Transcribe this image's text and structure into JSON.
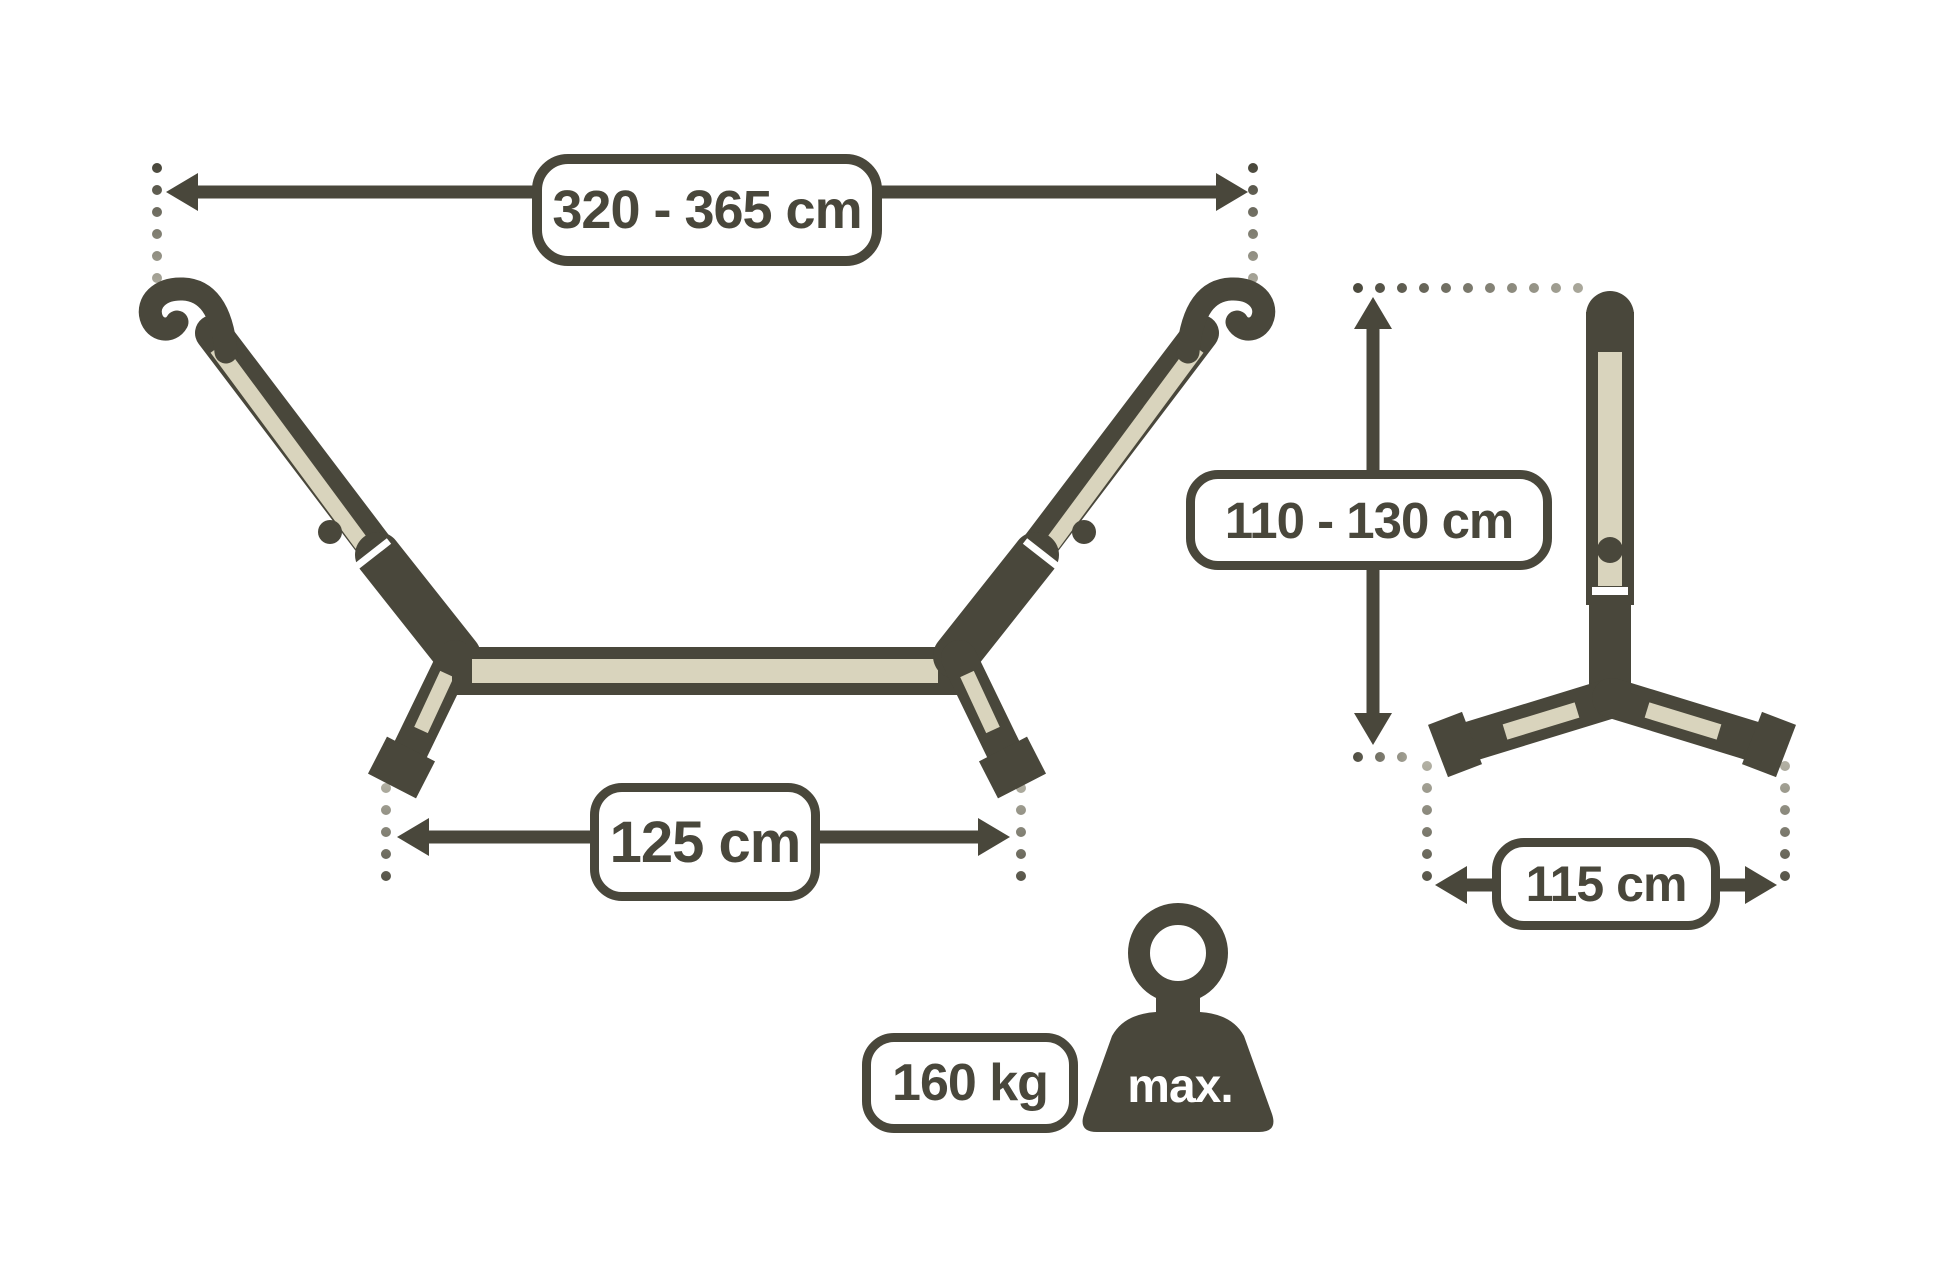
{
  "labels": {
    "overall_length": "320 - 365 cm",
    "front_base_width": "125 cm",
    "stand_height": "110 - 130 cm",
    "side_base_depth": "115 cm",
    "max_load": "160 kg",
    "max_load_marker": "max."
  },
  "measurements": {
    "overall_length_cm": {
      "min": 320,
      "max": 365
    },
    "front_base_width_cm": 125,
    "stand_height_cm": {
      "min": 110,
      "max": 130
    },
    "side_base_depth_cm": 115,
    "max_load_kg": 160
  },
  "colors": {
    "outline": "#49473b",
    "tube_fill": "#d9d4bd",
    "background": "#ffffff",
    "fade_gray": "#b3b1a4"
  }
}
